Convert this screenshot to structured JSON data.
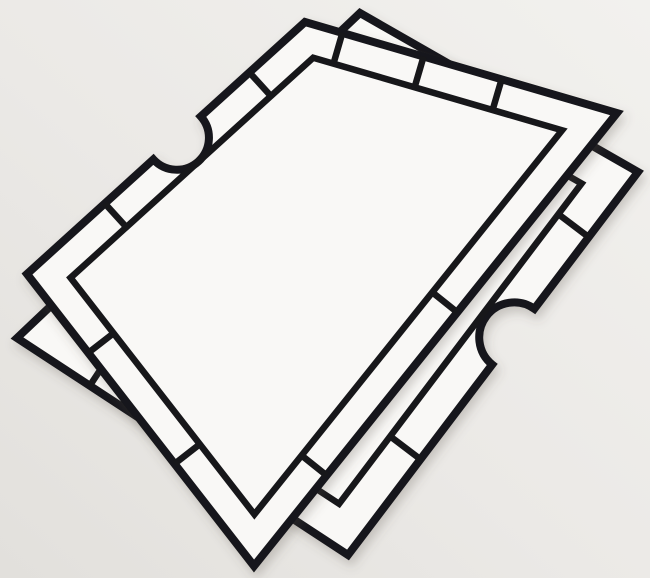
{
  "scene": {
    "type": "photograph",
    "subject": "two overlapping die-cut cardboard frame templates on a light surface",
    "canvas": {
      "width": 650,
      "height": 578
    }
  },
  "colors": {
    "background": "#ebe9e6",
    "background_highlight": "#f2f1ee",
    "background_shade": "#e2e0dc",
    "sheet": "#f9f8f6",
    "line": "#17171a",
    "shadow": "#575049"
  },
  "style": {
    "outer_stroke": 8,
    "inner_stroke": 6.5,
    "divider_stroke": 6.5
  },
  "edge_order": "0: top-to-right, 1: right-to-bottom, 2: bottom-to-left, 3: left-to-top",
  "frames": [
    {
      "id": "lower-right-frame",
      "z": "beneath",
      "corners": {
        "top": [
          360,
          13
        ],
        "right": [
          638,
          172
        ],
        "bottom": [
          348,
          555
        ],
        "left": [
          17,
          338
        ]
      },
      "band_width": 38,
      "notch": {
        "edge_index": 1,
        "t": 0.43,
        "radius": 35
      },
      "dividers": [
        {
          "edge_index": 0,
          "t": [
            0.3,
            0.65
          ]
        },
        {
          "edge_index": 1,
          "t": [
            0.17,
            0.75
          ]
        },
        {
          "edge_index": 2,
          "t": [
            0.35,
            0.78
          ]
        },
        {
          "edge_index": 3,
          "t": [
            0.25,
            0.6
          ]
        }
      ]
    },
    {
      "id": "upper-left-frame",
      "z": "on-top",
      "corners": {
        "top": [
          305,
          22
        ],
        "right": [
          617,
          113
        ],
        "bottom": [
          254,
          566
        ],
        "left": [
          27,
          274
        ]
      },
      "band_width": 32,
      "notch": {
        "edge_index": 3,
        "t": 0.54,
        "radius": 32
      },
      "dividers": [
        {
          "edge_index": 0,
          "t": [
            0.12,
            0.38,
            0.63
          ]
        },
        {
          "edge_index": 1,
          "t": [
            0.44,
            0.8
          ]
        },
        {
          "edge_index": 2,
          "t": [
            0.35,
            0.73
          ]
        },
        {
          "edge_index": 3,
          "t": [
            0.28,
            0.8
          ]
        }
      ]
    }
  ]
}
